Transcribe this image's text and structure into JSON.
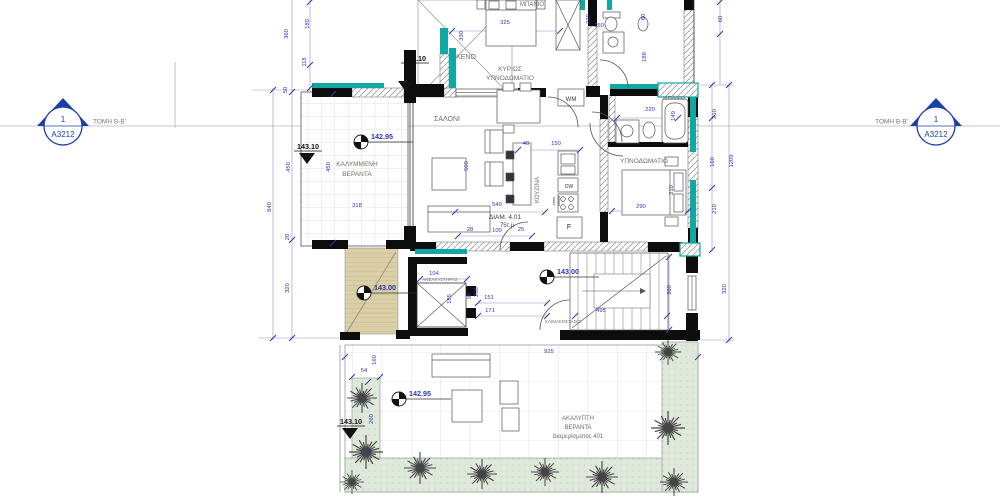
{
  "title": "Floor plan - apartment 401",
  "colors": {
    "dim_blue": "#2f35b3",
    "label_gray": "#6e6e68",
    "level_black": "#111111",
    "teal": "#11a7a3",
    "wall_black": "#0d0d0d",
    "marker_blue": "#1b3faa",
    "planter_green": "#dfe9db",
    "ramp_tan": "#dacfa6"
  },
  "section": {
    "left": {
      "number": "1",
      "sheet": "A3212",
      "label": "ΤΟΜΗ Β-Β'"
    },
    "right": {
      "number": "1",
      "sheet": "A3212",
      "label": "ΤΟΜΗ Β-Β'"
    }
  },
  "labels": [
    {
      "t": "ΚΕΝΟ",
      "x": 466,
      "y": 59,
      "s": 7
    },
    {
      "t": "ΚΥΡΙΩΣ",
      "x": 510,
      "y": 71,
      "s": 6.5
    },
    {
      "t": "ΥΠΝΟΔΩΜΑΤΙΟ",
      "x": 510,
      "y": 80,
      "s": 6.5
    },
    {
      "t": "ΜΠΑΝΙΟ",
      "x": 532,
      "y": 6,
      "s": 6
    },
    {
      "t": "ΜΠΑΝΙΟ",
      "x": 674,
      "y": 100,
      "s": 5.5
    },
    {
      "t": "ΣΑΛΟΝΙ",
      "x": 447,
      "y": 121,
      "s": 7
    },
    {
      "t": "ΚΟΥΖΙΝΑ",
      "x": 539,
      "y": 190,
      "s": 6,
      "r": -90
    },
    {
      "t": "ΥΠΝΟΔΩΜΑΤΙΟ",
      "x": 644,
      "y": 163,
      "s": 6.5
    },
    {
      "t": "ΚΑΛΥΜΜΕΝΗ",
      "x": 357,
      "y": 166,
      "s": 6.5
    },
    {
      "t": "ΒΕΡΑΝΤΑ",
      "x": 357,
      "y": 176,
      "s": 6.5
    },
    {
      "t": "ΑΝΕΛΚΥΣΤΗΡΑΣ",
      "x": 440,
      "y": 281,
      "s": 4.5
    },
    {
      "t": "ΚΛΙΜΑΚΟΣΤΑΣΙΟ",
      "x": 563,
      "y": 323,
      "s": 4.5
    },
    {
      "t": "ΑΚΑΛΥΠΤΗ",
      "x": 578,
      "y": 420,
      "s": 6
    },
    {
      "t": "ΒΕΡΑΝΤΑ",
      "x": 578,
      "y": 429,
      "s": 6
    },
    {
      "t": "Διαμερίσματος 401",
      "x": 578,
      "y": 438,
      "s": 6
    },
    {
      "t": "ΔΙΑΜ. 4.01",
      "x": 505,
      "y": 219,
      "s": 6.5,
      "c": "#3c3c3c"
    },
    {
      "t": "75τ.μ",
      "x": 507,
      "y": 227,
      "s": 6,
      "c": "#3c3c3c"
    },
    {
      "t": "WM",
      "x": 571,
      "y": 101,
      "s": 6,
      "c": "#333333"
    },
    {
      "t": "DW",
      "x": 569,
      "y": 188,
      "s": 5,
      "c": "#333333"
    },
    {
      "t": "oven",
      "x": 555,
      "y": 201,
      "s": 4,
      "r": -90,
      "c": "#333333"
    },
    {
      "t": "below",
      "x": 560,
      "y": 201,
      "s": 4,
      "r": -90,
      "c": "#333333"
    },
    {
      "t": "F",
      "x": 569,
      "y": 229,
      "s": 7,
      "c": "#222222"
    }
  ],
  "dimensions": [
    {
      "t": "360",
      "x": 288,
      "y": 34,
      "r": -90
    },
    {
      "t": "180",
      "x": 309,
      "y": 24,
      "r": -90
    },
    {
      "t": "118",
      "x": 306,
      "y": 62,
      "r": -90
    },
    {
      "t": "50",
      "x": 287,
      "y": 90,
      "r": -90
    },
    {
      "t": "840",
      "x": 271,
      "y": 207,
      "r": -90
    },
    {
      "t": "450",
      "x": 290,
      "y": 167,
      "r": -90
    },
    {
      "t": "450",
      "x": 330,
      "y": 167,
      "r": -90
    },
    {
      "t": "20",
      "x": 289,
      "y": 237,
      "r": -90
    },
    {
      "t": "320",
      "x": 289,
      "y": 288,
      "r": -90
    },
    {
      "t": "318",
      "x": 357,
      "y": 207,
      "r": 0
    },
    {
      "t": "325",
      "x": 505,
      "y": 24,
      "r": 0
    },
    {
      "t": "330",
      "x": 463,
      "y": 36,
      "r": -90
    },
    {
      "t": "220",
      "x": 590,
      "y": 19,
      "r": -90
    },
    {
      "t": "150",
      "x": 599,
      "y": 27,
      "r": 0
    },
    {
      "t": "60",
      "x": 645,
      "y": 17,
      "r": -90
    },
    {
      "t": "188",
      "x": 646,
      "y": 57,
      "r": -90
    },
    {
      "t": "60",
      "x": 722,
      "y": 19,
      "r": -90
    },
    {
      "t": "220",
      "x": 650,
      "y": 111,
      "r": 0
    },
    {
      "t": "140",
      "x": 675,
      "y": 116,
      "r": -90
    },
    {
      "t": "290",
      "x": 641,
      "y": 208,
      "r": 0
    },
    {
      "t": "210",
      "x": 673,
      "y": 190,
      "r": -90
    },
    {
      "t": "210",
      "x": 716,
      "y": 114,
      "r": -90
    },
    {
      "t": "160",
      "x": 714,
      "y": 162,
      "r": -90
    },
    {
      "t": "210",
      "x": 716,
      "y": 209,
      "r": -90
    },
    {
      "t": "1209",
      "x": 733,
      "y": 161,
      "r": -90
    },
    {
      "t": "40",
      "x": 526,
      "y": 145,
      "r": 0
    },
    {
      "t": "150",
      "x": 556,
      "y": 145,
      "r": 0
    },
    {
      "t": "500",
      "x": 468,
      "y": 166,
      "r": -90
    },
    {
      "t": "540",
      "x": 497,
      "y": 206,
      "r": 0
    },
    {
      "t": "28",
      "x": 470,
      "y": 231,
      "r": 0
    },
    {
      "t": "100",
      "x": 497,
      "y": 232,
      "r": 0
    },
    {
      "t": "25",
      "x": 521,
      "y": 231,
      "r": 0
    },
    {
      "t": "104",
      "x": 434,
      "y": 275,
      "r": 0
    },
    {
      "t": "185",
      "x": 451,
      "y": 299,
      "r": -90
    },
    {
      "t": "90",
      "x": 471,
      "y": 296,
      "r": -90
    },
    {
      "t": "260",
      "x": 478,
      "y": 292,
      "r": -90
    },
    {
      "t": "151",
      "x": 489,
      "y": 299,
      "r": 0
    },
    {
      "t": "171",
      "x": 490,
      "y": 312,
      "r": 0
    },
    {
      "t": "495",
      "x": 601,
      "y": 312,
      "r": 0
    },
    {
      "t": "925",
      "x": 549,
      "y": 353,
      "r": 0
    },
    {
      "t": "360",
      "x": 671,
      "y": 290,
      "r": -90
    },
    {
      "t": "320",
      "x": 726,
      "y": 289,
      "r": -90
    },
    {
      "t": "54",
      "x": 364,
      "y": 372,
      "r": 0
    },
    {
      "t": "160",
      "x": 376,
      "y": 360,
      "r": -90
    },
    {
      "t": "260",
      "x": 373,
      "y": 419,
      "r": -90
    }
  ],
  "levels": [
    {
      "v": "143.10",
      "type": "tri",
      "tx": 415,
      "ty": 61,
      "cx": 406,
      "toff": 18
    },
    {
      "v": "143.10",
      "type": "tri",
      "tx": 308,
      "ty": 149,
      "cx": 307,
      "toff": 2
    },
    {
      "v": "143.10",
      "type": "tri",
      "tx": 351,
      "ty": 424,
      "cx": 350,
      "toff": 2
    },
    {
      "v": "142.95",
      "type": "circ",
      "sx": 361,
      "sy": 142
    },
    {
      "v": "142.95",
      "type": "circ",
      "sx": 399,
      "sy": 399
    },
    {
      "v": "143.00",
      "type": "circ",
      "sx": 364,
      "sy": 293
    },
    {
      "v": "143.00",
      "type": "circ",
      "sx": 547,
      "sy": 277
    }
  ]
}
